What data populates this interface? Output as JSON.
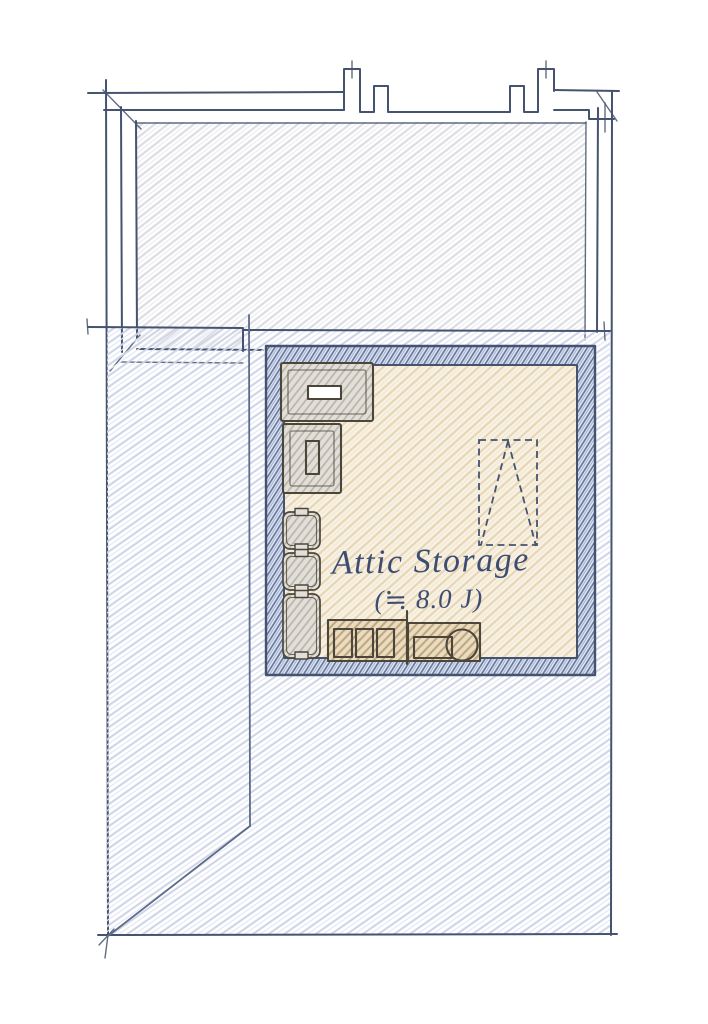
{
  "drawing": {
    "room_label": "Attic Storage",
    "room_area": "(≒ 8.0 J)"
  },
  "legend": {
    "type": "hand-drawn attic floor plan sketch",
    "elements": [
      "upper-roof-outline-with-vent-notches",
      "lower-roof-plane-with-valley-lines",
      "attic-storage-room",
      "wide-cabinet",
      "tall-cabinet",
      "storage-box-1",
      "storage-box-2",
      "storage-box-3",
      "shelf-unit-3-compartments",
      "equipment-unit-with-drum",
      "folding-ladder-dashed-symbol"
    ]
  },
  "colors": {
    "paper": "#ffffff",
    "ink": "#46536f",
    "ink_soft": "#5d6a88",
    "gray_hatch": "#dcdde3",
    "gray_hatch2": "#ededf1",
    "roof_hatch": "#ccd3e7",
    "roof_hatch2": "#e4e7f3",
    "wall_bg": "#e4e9f3",
    "wall_hatch": "#62769f",
    "wall_hatch2": "#97a5c6",
    "floor_bg": "#f8f2e4",
    "floor_hatch": "#e7d5b4",
    "floor_hatch2": "#f2e8d4",
    "tan_bg": "#e8dcc3",
    "tan_hatch": "#c2a578",
    "box_bg": "#e2dfd8",
    "box_hatch": "#b9b5ab",
    "furniture_line": "#4c463a",
    "label_ink": "#3d4d72"
  }
}
